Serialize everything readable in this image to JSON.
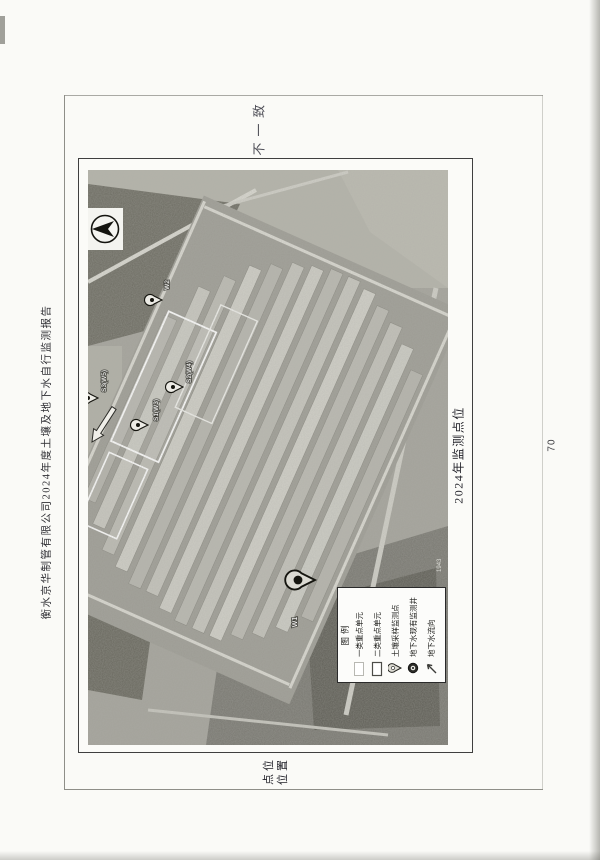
{
  "document": {
    "header_title": "衡水京华制管有限公司2024年度土壤及地下水自行监测报告",
    "page_number": "70",
    "handwritten_note": "不一致",
    "row_header_line1": "点位",
    "row_header_line2": "位置",
    "figure_caption": "2024年监测点位"
  },
  "legend": {
    "title": "图例",
    "items": [
      {
        "label": "一类重点单元",
        "icon": "class1-unit-rect-icon"
      },
      {
        "label": "二类重点单元",
        "icon": "class2-unit-rect-icon"
      },
      {
        "label": "土壤采样监测点",
        "icon": "soil-sampling-pin-icon"
      },
      {
        "label": "地下水现有监测井",
        "icon": "groundwater-well-icon"
      },
      {
        "label": "地下水流向",
        "icon": "flow-arrow-icon"
      }
    ]
  },
  "map": {
    "type": "grayscale-satellite-photo",
    "watermark": "1943",
    "markers": [
      {
        "id": "m1",
        "label": "S3(W5)"
      },
      {
        "id": "m2",
        "label": "S1(W3)"
      },
      {
        "id": "m3",
        "label": "S2(W4)"
      },
      {
        "id": "m4",
        "label": "W2"
      },
      {
        "id": "m5",
        "label": "W1"
      }
    ]
  },
  "colors": {
    "paper": "#fafaf7",
    "frame_border": "#3f3f3f",
    "map_base": "#a3a29a",
    "unit_outline": "#ffffff"
  }
}
